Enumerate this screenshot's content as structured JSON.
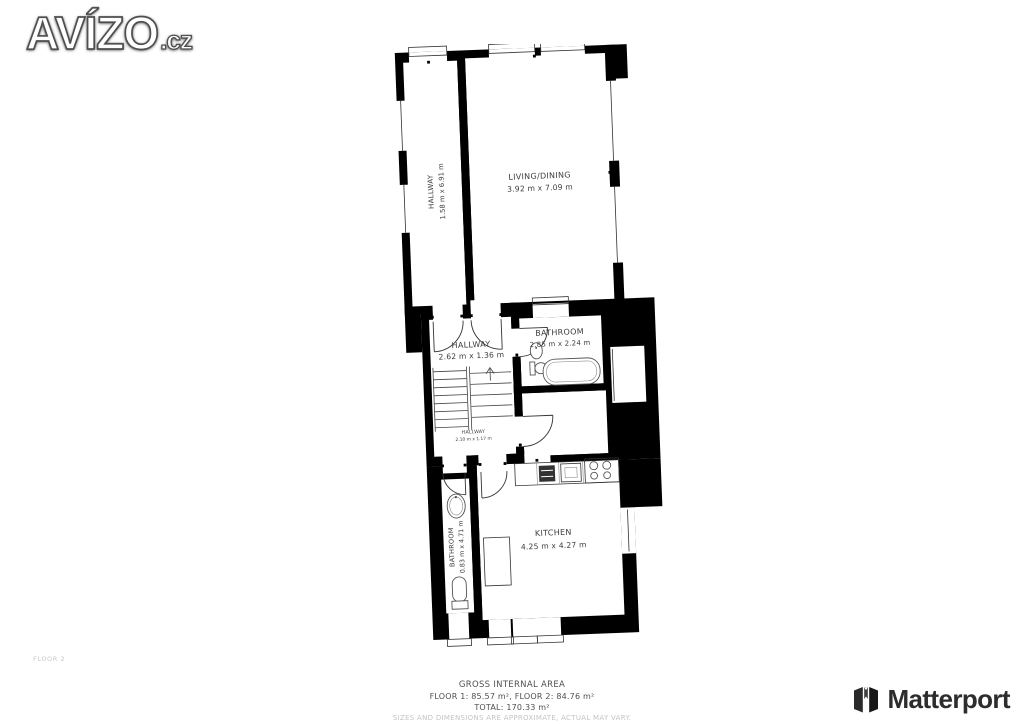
{
  "logo": {
    "name": "AVÍZO",
    "tld": ".cz"
  },
  "floorplan": {
    "floor_label": "FLOOR 2",
    "rooms": {
      "hallway_top": {
        "name": "HALLWAY",
        "dims": "1.58 m x 6.91 m"
      },
      "living": {
        "name": "LIVING/DINING",
        "dims": "3.92 m x 7.09 m"
      },
      "hallway_mid": {
        "name": "HALLWAY",
        "dims": "2.62 m x 1.36 m"
      },
      "bathroom_mid": {
        "name": "BATHROOM",
        "dims": "2.85 m x 2.24 m"
      },
      "hallway_small": {
        "name": "HALLWAY",
        "dims": "2.10 m x 1.17 m"
      },
      "bathroom_bottom": {
        "name": "BATHROOM",
        "dims": "0.83 m x 4.71 m"
      },
      "kitchen": {
        "name": "KITCHEN",
        "dims": "4.25 m x 4.27 m"
      }
    }
  },
  "footer": {
    "title": "GROSS INTERNAL AREA",
    "floors": "FLOOR 1: 85.57 m², FLOOR 2: 84.76 m²",
    "total": "TOTAL: 170.33 m²",
    "disclaimer": "SIZES AND DIMENSIONS ARE APPROXIMATE, ACTUAL MAY VARY."
  },
  "branding": {
    "matterport": "Matterport"
  },
  "colors": {
    "walls": "#000000",
    "label_text": "#3c3c3c",
    "footer_text": "#4f4f4f",
    "disclaimer_text": "#c4c4c4",
    "logo_fill": "#ffffff",
    "logo_outline": "#4f4f4f",
    "matterport_dark": "#2d2d2d"
  }
}
